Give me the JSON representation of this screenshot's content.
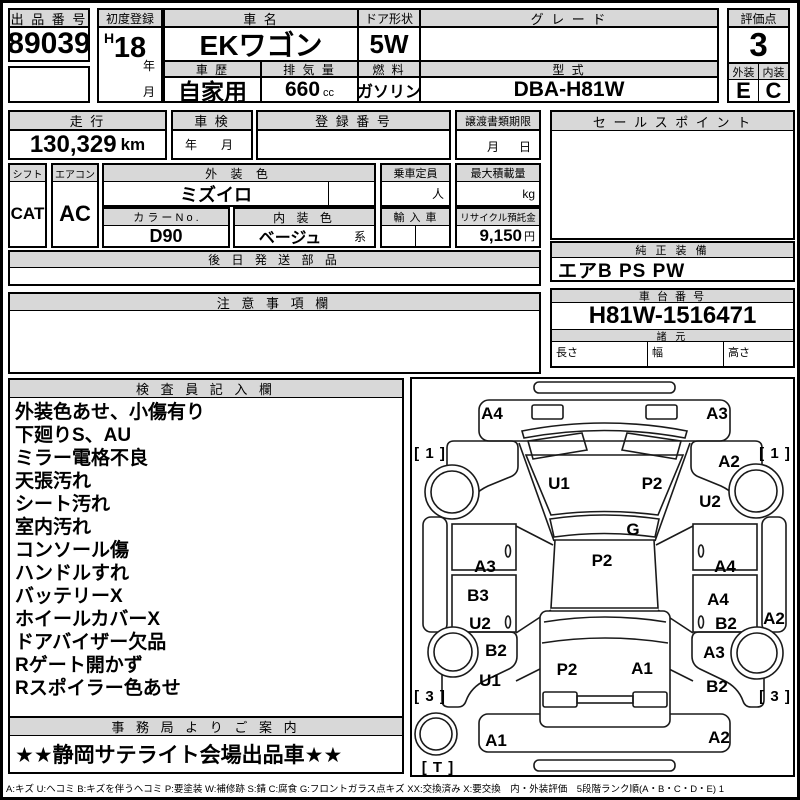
{
  "sheet": {
    "auction_no": {
      "label": "出 品 番 号",
      "value": "89039"
    },
    "first_reg": {
      "label": "初度登録",
      "era": "H",
      "year": "18",
      "year_suffix": "年",
      "month_suffix": "月"
    },
    "car_name": {
      "label": "車 名",
      "value": "EKワゴン"
    },
    "door": {
      "label": "ドア形状",
      "value": "5W"
    },
    "grade": {
      "label": "グ レ ー ド",
      "value": ""
    },
    "score": {
      "label": "評価点",
      "value": "3"
    },
    "history": {
      "label": "車 歴",
      "value": "自家用"
    },
    "displacement": {
      "label": "排 気 量",
      "value": "660",
      "unit": "cc"
    },
    "fuel": {
      "label": "燃 料",
      "value": "ガソリン"
    },
    "model": {
      "label": "型 式",
      "value": "DBA-H81W"
    },
    "exterior": {
      "label": "外装",
      "value": "E"
    },
    "interior": {
      "label": "内装",
      "value": "C"
    },
    "mileage": {
      "label": "走 行",
      "value": "130,329",
      "unit": "km"
    },
    "inspection": {
      "label": "車 検",
      "value": "年　月"
    },
    "reg_no": {
      "label": "登 録 番 号",
      "value": ""
    },
    "transfer": {
      "label": "譲渡書類期限",
      "value": "月　日"
    },
    "shift": {
      "label": "シフト",
      "value": "CAT"
    },
    "aircon": {
      "label": "エアコン",
      "value": "AC"
    },
    "ext_color": {
      "label": "外 装 色",
      "value": "ミズイロ"
    },
    "capacity": {
      "label": "乗車定員",
      "unit": "人"
    },
    "max_load": {
      "label": "最大積載量",
      "unit": "kg"
    },
    "color_no": {
      "label": "カ ラ ー N o .",
      "value": "D90"
    },
    "int_color": {
      "label": "内 装 色",
      "value": "ベージュ",
      "suffix": "系"
    },
    "import_car": {
      "label": "輸 入 車"
    },
    "recycle": {
      "label": "リサイクル預託金",
      "value": "9,150",
      "unit": "円"
    },
    "later_parts": {
      "label": "後 日 発 送 部 品",
      "value": ""
    },
    "caution": {
      "label": "注 意 事 項 欄",
      "value": ""
    },
    "sales_point": {
      "label": "セ ー ル ス ポ イ ン ト",
      "value": ""
    },
    "equipment": {
      "label": "純 正 装 備",
      "value": "エアB PS PW"
    },
    "chassis_no": {
      "label": "車 台 番 号",
      "value": "H81W-1516471"
    },
    "specs": {
      "label": "諸 元",
      "length_label": "長さ",
      "width_label": "幅",
      "height_label": "高さ"
    },
    "inspector": {
      "label": "検 査 員 記 入 欄",
      "lines": [
        "外装色あせ、小傷有り",
        "下廻りS、AU",
        "ミラー電格不良",
        "天張汚れ",
        "シート汚れ",
        "室内汚れ",
        "コンソール傷",
        "ハンドルすれ",
        "バッテリーX",
        "ホイールカバーX",
        "ドアバイザー欠品",
        "Rゲート開かず",
        "Rスポイラー色あせ"
      ]
    },
    "office": {
      "label": "事 務 局 よ り ご 案 内",
      "value": "★★静岡サテライト会場出品車★★"
    },
    "legend": "A:キズ U:ヘコミ B:キズを伴うヘコミ P:要塗装 W:補修跡 S:錆 C:腐食 G:フロントガラス点キズ XX:交換済み X:要交換　内・外装評価　5段階ランク順(A・B・C・D・E) 1"
  },
  "diagram": {
    "labels": [
      {
        "t": "A4",
        "x": 80,
        "y": 40
      },
      {
        "t": "A3",
        "x": 305,
        "y": 40
      },
      {
        "t": "U1",
        "x": 147,
        "y": 110
      },
      {
        "t": "P2",
        "x": 240,
        "y": 110
      },
      {
        "t": "A2",
        "x": 317,
        "y": 88
      },
      {
        "t": "U2",
        "x": 298,
        "y": 128
      },
      {
        "t": "G",
        "x": 221,
        "y": 156
      },
      {
        "t": "P2",
        "x": 190,
        "y": 187
      },
      {
        "t": "A3",
        "x": 73,
        "y": 193
      },
      {
        "t": "A4",
        "x": 313,
        "y": 193
      },
      {
        "t": "B3",
        "x": 66,
        "y": 222
      },
      {
        "t": "A4",
        "x": 306,
        "y": 226
      },
      {
        "t": "U2",
        "x": 68,
        "y": 250
      },
      {
        "t": "B2",
        "x": 314,
        "y": 250
      },
      {
        "t": "A2",
        "x": 362,
        "y": 245
      },
      {
        "t": "B2",
        "x": 84,
        "y": 277
      },
      {
        "t": "A3",
        "x": 302,
        "y": 279
      },
      {
        "t": "P2",
        "x": 155,
        "y": 296
      },
      {
        "t": "A1",
        "x": 230,
        "y": 295
      },
      {
        "t": "U1",
        "x": 78,
        "y": 307
      },
      {
        "t": "B2",
        "x": 305,
        "y": 313
      },
      {
        "t": "A1",
        "x": 84,
        "y": 367
      },
      {
        "t": "A2",
        "x": 307,
        "y": 364
      }
    ],
    "brackets": [
      {
        "t": "[ 1 ]",
        "x": 18,
        "y": 79
      },
      {
        "t": "[ 1 ]",
        "x": 363,
        "y": 79
      },
      {
        "t": "[ 3 ]",
        "x": 18,
        "y": 322
      },
      {
        "t": "[ 3 ]",
        "x": 363,
        "y": 322
      },
      {
        "t": "[ T ]",
        "x": 26,
        "y": 393
      }
    ]
  }
}
